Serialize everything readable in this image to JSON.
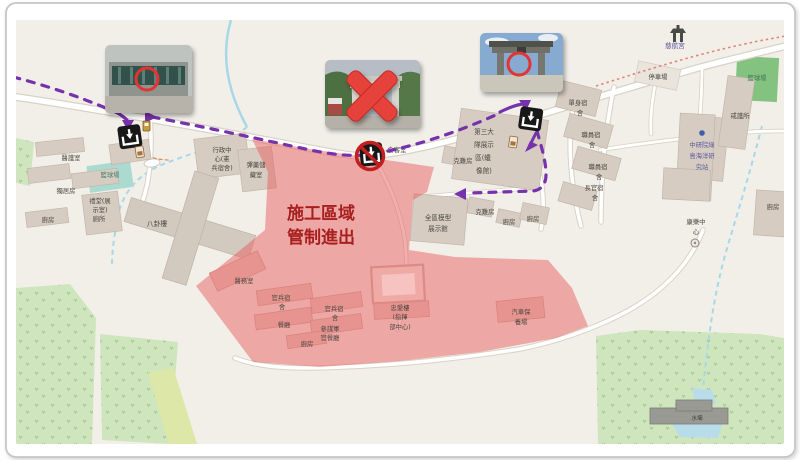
{
  "map": {
    "title": "施工區域管制進出地圖",
    "construction_notice": {
      "line1": "施工區域",
      "line2": "管制進出"
    },
    "colors": {
      "land": "#f2efe9",
      "building": "#d6ccc2",
      "restricted_zone": "#e85f5f",
      "route_purple": "#7632ad",
      "annotation_red": "#d92f27",
      "water": "#a6d8e8",
      "vegetation": "#cfe5bd",
      "notice_text": "#a81f1f"
    },
    "labels": [
      {
        "name": "label-medical-room",
        "text": "醫護室",
        "x": 71,
        "y": 160
      },
      {
        "name": "label-basketball-west",
        "text": "籃球場",
        "x": 110,
        "y": 177,
        "color": "#41806a"
      },
      {
        "name": "label-solitary-cells",
        "text": "獨居房",
        "x": 66,
        "y": 193
      },
      {
        "name": "label-auditorium-1",
        "text": "禮堂(展",
        "x": 100,
        "y": 203
      },
      {
        "name": "label-auditorium-2",
        "text": "示室)",
        "x": 100,
        "y": 212
      },
      {
        "name": "label-toilet",
        "text": "廁所",
        "x": 99,
        "y": 221
      },
      {
        "name": "label-kitchen-west",
        "text": "廚房",
        "x": 48,
        "y": 222
      },
      {
        "name": "label-bagua-building",
        "text": "八卦樓",
        "x": 157,
        "y": 226,
        "fs": 6.8
      },
      {
        "name": "label-admin-1",
        "text": "行政中",
        "x": 222,
        "y": 152
      },
      {
        "name": "label-admin-2",
        "text": "心(憲",
        "x": 222,
        "y": 161
      },
      {
        "name": "label-admin-3",
        "text": "兵宿舍)",
        "x": 222,
        "y": 170
      },
      {
        "name": "label-ammo-1",
        "text": "彈藥儲",
        "x": 256,
        "y": 167
      },
      {
        "name": "label-ammo-2",
        "text": "藏室",
        "x": 256,
        "y": 177
      },
      {
        "name": "notice-line-1",
        "text": "施工區域",
        "x": 321,
        "y": 219,
        "fs": 17,
        "color": "#a81f1f",
        "fw": "bold"
      },
      {
        "name": "notice-line-2",
        "text": "管制進出",
        "x": 321,
        "y": 243,
        "fs": 17,
        "color": "#a81f1f",
        "fw": "bold"
      },
      {
        "name": "label-infirmary",
        "text": "醫務室",
        "x": 244,
        "y": 283
      },
      {
        "name": "label-troop-dorm1-1",
        "text": "官兵宿",
        "x": 281,
        "y": 300
      },
      {
        "name": "label-troop-dorm1-2",
        "text": "舍",
        "x": 282,
        "y": 309
      },
      {
        "name": "label-troop-dorm2-1",
        "text": "官兵宿",
        "x": 334,
        "y": 311
      },
      {
        "name": "label-troop-dorm2-2",
        "text": "舍",
        "x": 335,
        "y": 320
      },
      {
        "name": "label-canteen",
        "text": "餐廳",
        "x": 284,
        "y": 327
      },
      {
        "name": "label-staff-canteen-1",
        "text": "參謀軍",
        "x": 330,
        "y": 331
      },
      {
        "name": "label-staff-canteen-2",
        "text": "官餐廳",
        "x": 330,
        "y": 340
      },
      {
        "name": "label-kitchen-zone",
        "text": "廚房",
        "x": 307,
        "y": 346
      },
      {
        "name": "label-zhongai-1",
        "text": "忠愛樓",
        "x": 400,
        "y": 310
      },
      {
        "name": "label-zhongai-2",
        "text": "(指揮",
        "x": 400,
        "y": 319
      },
      {
        "name": "label-zhongai-3",
        "text": "部中心)",
        "x": 400,
        "y": 329
      },
      {
        "name": "label-motorpool-1",
        "text": "汽車保",
        "x": 521,
        "y": 314
      },
      {
        "name": "label-motorpool-2",
        "text": "養場",
        "x": 521,
        "y": 324
      },
      {
        "name": "label-model-hall-1",
        "text": "全區模型",
        "x": 438,
        "y": 220,
        "fs": 6.6
      },
      {
        "name": "label-model-hall-2",
        "text": "展示館",
        "x": 438,
        "y": 231,
        "fs": 6.6
      },
      {
        "name": "label-kenan-a",
        "text": "克難房",
        "x": 463,
        "y": 163
      },
      {
        "name": "label-kenan-b",
        "text": "克難房",
        "x": 485,
        "y": 214
      },
      {
        "name": "label-kitchen-c",
        "text": "廚房",
        "x": 509,
        "y": 224
      },
      {
        "name": "label-kitchen-d",
        "text": "廚房",
        "x": 533,
        "y": 221
      },
      {
        "name": "label-wax-museum-1",
        "text": "第三大",
        "x": 484,
        "y": 134,
        "fs": 6.6
      },
      {
        "name": "label-wax-museum-2",
        "text": "隊展示",
        "x": 484,
        "y": 147,
        "fs": 6.6
      },
      {
        "name": "label-wax-museum-3",
        "text": "區(蠟",
        "x": 483,
        "y": 160,
        "fs": 6.6
      },
      {
        "name": "label-wax-museum-4",
        "text": "像館)",
        "x": 484,
        "y": 173,
        "fs": 6.6
      },
      {
        "name": "label-visitor-room",
        "text": "會客室",
        "x": 397,
        "y": 152
      },
      {
        "name": "label-single-dorm-1",
        "text": "單身宿",
        "x": 578,
        "y": 105
      },
      {
        "name": "label-single-dorm-2",
        "text": "舍",
        "x": 580,
        "y": 115
      },
      {
        "name": "label-staff-dorm1-1",
        "text": "職員宿",
        "x": 591,
        "y": 137
      },
      {
        "name": "label-staff-dorm1-2",
        "text": "舍",
        "x": 592,
        "y": 147
      },
      {
        "name": "label-staff-dorm2-1",
        "text": "職員宿",
        "x": 598,
        "y": 169
      },
      {
        "name": "label-staff-dorm2-2",
        "text": "舍",
        "x": 599,
        "y": 179
      },
      {
        "name": "label-officer-dorm-1",
        "text": "長官宿",
        "x": 594,
        "y": 190
      },
      {
        "name": "label-officer-dorm-2",
        "text": "舍",
        "x": 595,
        "y": 200
      },
      {
        "name": "label-parking",
        "text": "停車場",
        "x": 658,
        "y": 79
      },
      {
        "name": "label-cihang-temple",
        "text": "慈航宮",
        "x": 675,
        "y": 48,
        "color": "#55549b",
        "fs": 6.6
      },
      {
        "name": "label-basketball-east",
        "text": "籃球場",
        "x": 757,
        "y": 80,
        "color": "#3c7a50"
      },
      {
        "name": "label-guard-station",
        "text": "戒護所",
        "x": 740,
        "y": 118
      },
      {
        "name": "label-academia-1",
        "text": "中研院綠",
        "x": 702,
        "y": 147,
        "color": "#5b5b9e"
      },
      {
        "name": "label-academia-2",
        "text": "島海洋研",
        "x": 702,
        "y": 158,
        "color": "#5b5b9e"
      },
      {
        "name": "label-academia-3",
        "text": "究站",
        "x": 702,
        "y": 169,
        "color": "#5b5b9e"
      },
      {
        "name": "label-recreation-1",
        "text": "康樂中",
        "x": 696,
        "y": 224
      },
      {
        "name": "label-recreation-2",
        "text": "心",
        "x": 696,
        "y": 234
      },
      {
        "name": "label-kitchen-east",
        "text": "廚房",
        "x": 773,
        "y": 209
      },
      {
        "name": "label-dam",
        "text": "水壩",
        "x": 697,
        "y": 420,
        "fs": 5.6,
        "color": "#3f3f3a"
      }
    ]
  }
}
